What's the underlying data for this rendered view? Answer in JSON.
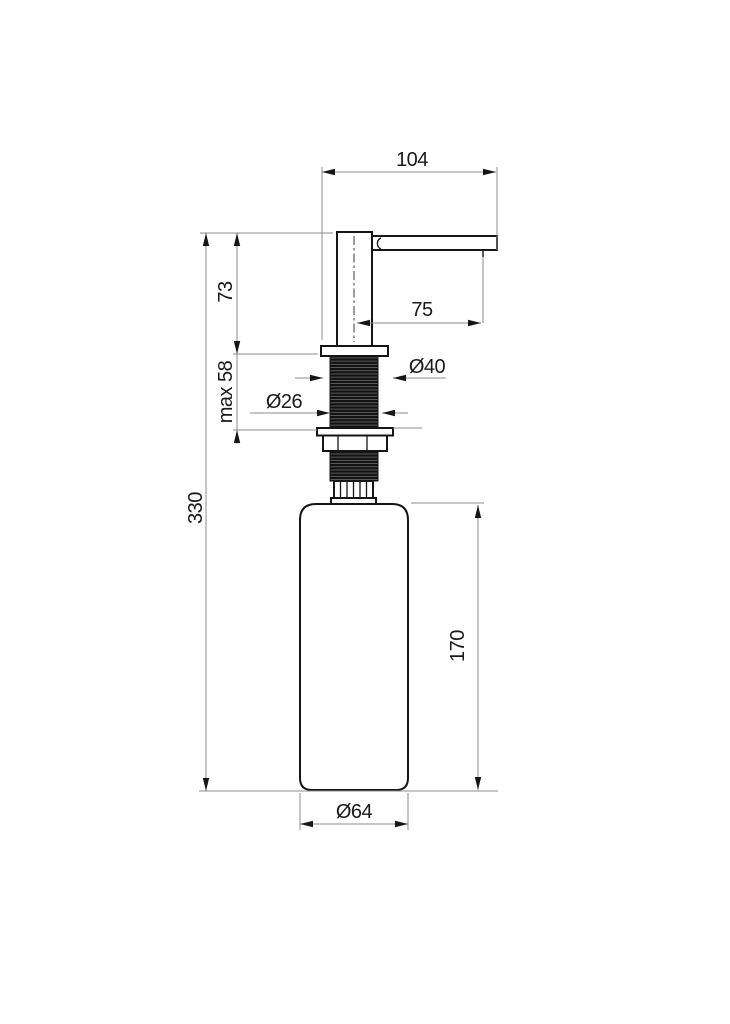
{
  "page": {
    "background": "#ffffff"
  },
  "drawing": {
    "kind": "technical dimension drawing",
    "subject": "kitchen sink soap dispenser, side elevation",
    "colors": {
      "object_line": "#161616",
      "dimension_line": "#8c8c8c",
      "text": "#1a1a1a",
      "background": "#ffffff"
    },
    "dimensions": {
      "overall_width": "104",
      "spout_reach": "75",
      "head_height": "73",
      "max_mounting": "max 58",
      "overall_height": "330",
      "trim_diameter": "Ø40",
      "thread_diameter": "Ø26",
      "bottle_height": "170",
      "bottle_diameter": "Ø64"
    }
  }
}
